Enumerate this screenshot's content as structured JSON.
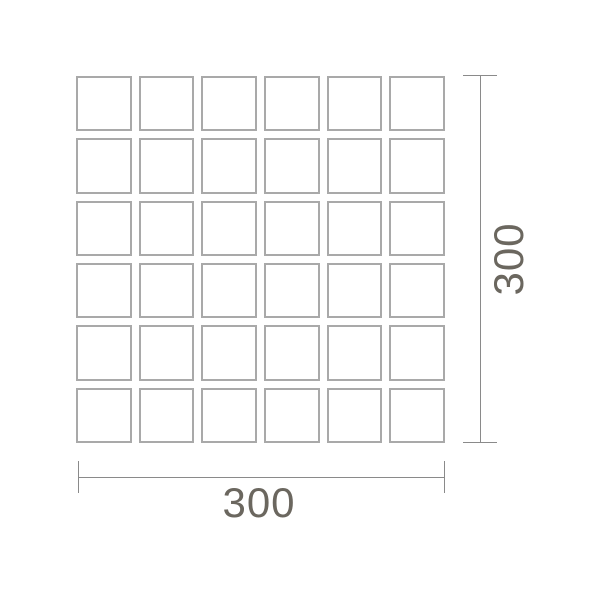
{
  "drawing": {
    "type": "tile-dimension-diagram",
    "grid": {
      "rows": 6,
      "cols": 6,
      "tile_count": 36
    },
    "dimensions": {
      "width_label": "300",
      "height_label": "300"
    },
    "colors": {
      "background": "#ffffff",
      "tile_border": "#a9a9a9",
      "dimension_line": "#8a8a8a",
      "dimension_text": "#6b675f"
    }
  }
}
